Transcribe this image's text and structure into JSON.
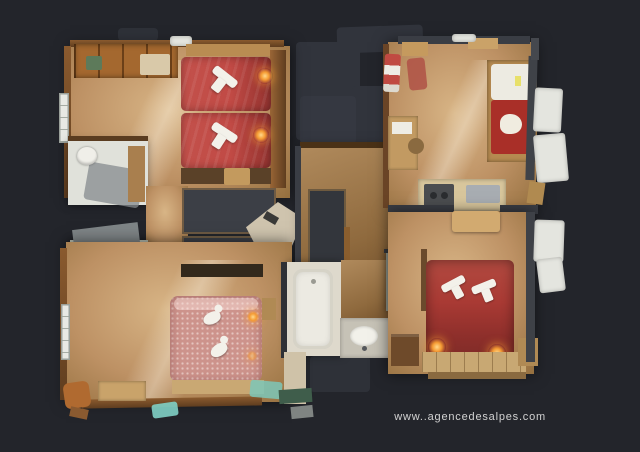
{
  "scene": {
    "description": "Top-down 3D dollhouse floor plan of a chalet apartment rendered with photographic textures on a dark charcoal background",
    "background_color": "#23252b"
  },
  "watermark": {
    "text": "www..agencedesalpes.com"
  },
  "colors": {
    "bg": "#23252b",
    "ghost": "#31343c",
    "wood_light": "#d8b586",
    "wood": "#bd9164",
    "wood_dark": "#95703f",
    "wall_wood": "#8a5a2e",
    "wall_wood_dark": "#5f3d1f",
    "wall_dark": "#3a3d44",
    "bed_red": "#c14a45",
    "bed_red_dark": "#963431",
    "bed_pink": "#cd938c",
    "bed_wine": "#a93a34",
    "towel": "#f3f1ea",
    "bath_white": "#e0e1da",
    "bath_gray": "#b5bbae",
    "tile_gray": "#8e948a",
    "glow": "#f59b33",
    "teal": "#7fd0c5",
    "watermark": "#d2d2d2"
  },
  "rooms": [
    {
      "id": "bedroom-twin",
      "label": "bedroom with two red single beds and folded towels"
    },
    {
      "id": "bathroom-upper-left",
      "label": "bathroom with toilet"
    },
    {
      "id": "bathroom-lower-left",
      "label": "bathroom with toilet and sink"
    },
    {
      "id": "bedroom-pink",
      "label": "bedroom with pink double bed"
    },
    {
      "id": "hallway",
      "label": "entrance hallway"
    },
    {
      "id": "bathroom-center",
      "label": "bathroom with bathtub and washbasin"
    },
    {
      "id": "wc",
      "label": "separate WC"
    },
    {
      "id": "living-kitchen",
      "label": "living room with sofa, desk and kitchenette"
    },
    {
      "id": "bedroom-wine",
      "label": "bedroom with dark red double bed and lit bedside lamps"
    }
  ]
}
